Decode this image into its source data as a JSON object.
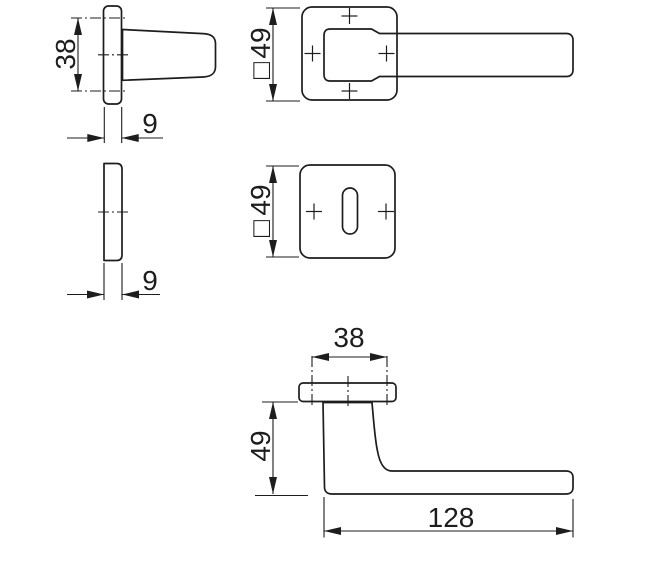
{
  "page": {
    "background_color": "#ffffff",
    "line_color": "#1d1d1d"
  },
  "views": {
    "lever_side": {
      "labels": {
        "hole_spacing": "38",
        "rosette_thickness": "9"
      }
    },
    "lever_front": {
      "labels": {
        "square_symbol": "□",
        "rosette_size": "49"
      }
    },
    "key_rosette_side": {
      "labels": {
        "rosette_thickness": "9"
      }
    },
    "key_rosette_front": {
      "labels": {
        "square_symbol": "□",
        "rosette_size": "49"
      }
    },
    "handle_top": {
      "labels": {
        "hub_width": "38",
        "handle_projection": "49",
        "handle_length": "128"
      }
    }
  }
}
